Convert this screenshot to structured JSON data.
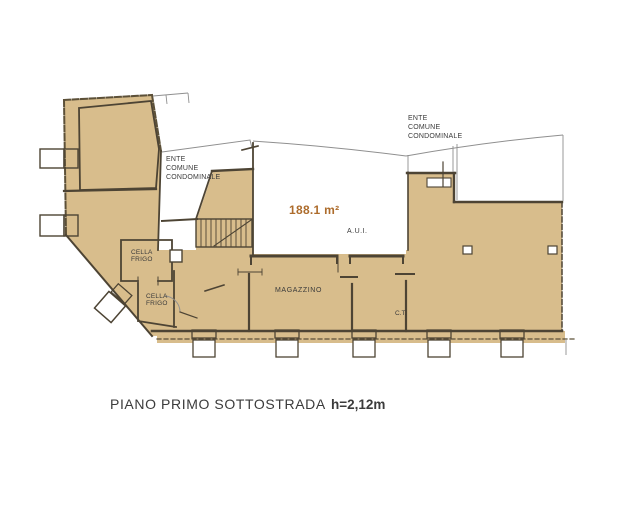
{
  "colors": {
    "fill": "#d8bd8c",
    "wall": "#4d4434",
    "outer": "#5c5038",
    "boundary": "#8f8f8f",
    "text": "#3a3a3a",
    "area_text": "#ad6c2c"
  },
  "labels": {
    "ente_left": {
      "l1": "ENTE",
      "l2": "COMUNE",
      "l3": "CONDOMINALE"
    },
    "ente_right": {
      "l1": "ENTE",
      "l2": "COMUNE",
      "l3": "CONDOMINALE"
    },
    "area": "188.1 m²",
    "aui": "A.U.I.",
    "cella1": {
      "l1": "CELLA",
      "l2": "FRIGO"
    },
    "cella2": {
      "l1": "CELLA",
      "l2": "FRIGO"
    },
    "magazzino": "MAGAZZINO",
    "ct": "C.T."
  },
  "caption": {
    "title": "PIANO PRIMO SOTTOSTRADA",
    "height": "h=2,12m"
  }
}
